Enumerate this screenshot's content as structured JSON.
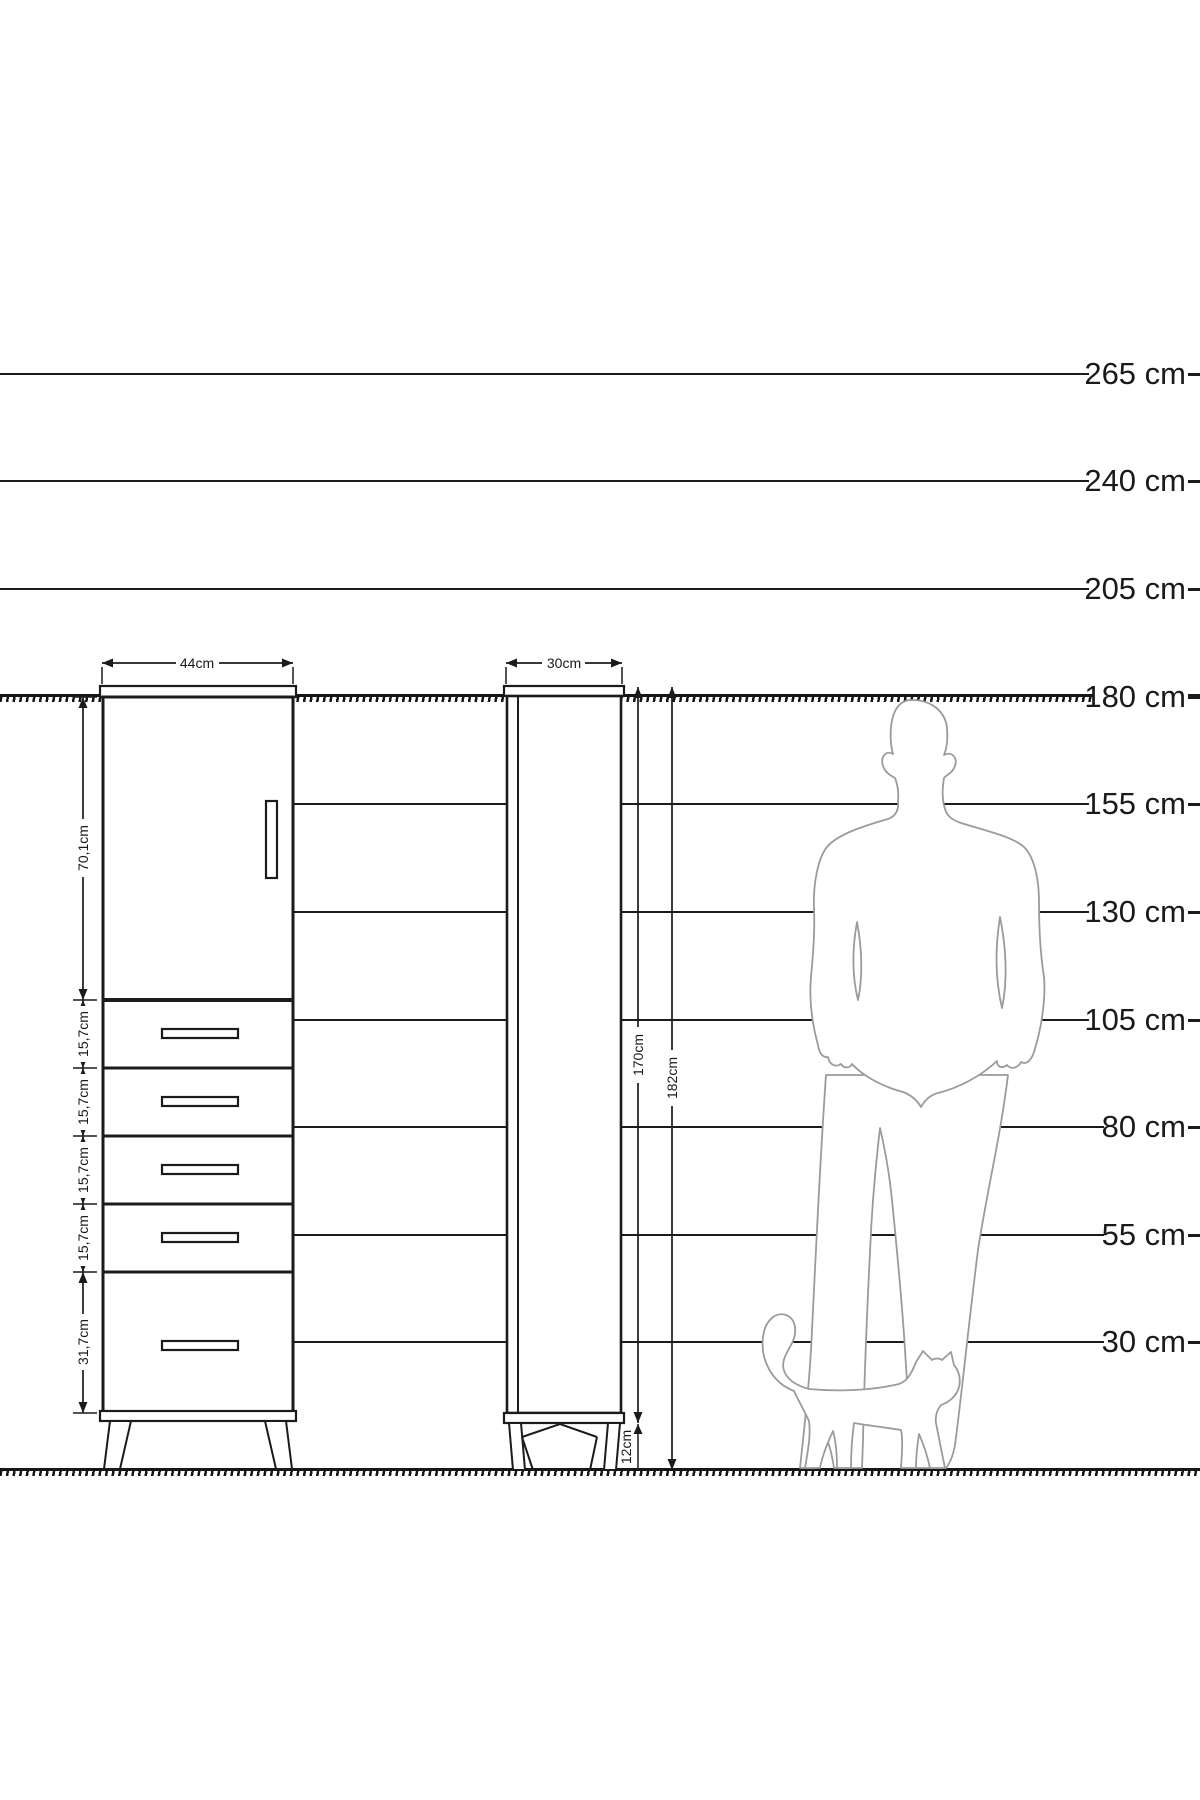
{
  "diagram": {
    "title": "Cabinet dimensions with human and cat height reference",
    "views": [
      "front view",
      "side view"
    ]
  },
  "scale": {
    "unit": "cm",
    "lines": [
      {
        "value": 265,
        "label": "265 cm"
      },
      {
        "value": 240,
        "label": "240 cm"
      },
      {
        "value": 205,
        "label": "205 cm"
      },
      {
        "value": 180,
        "label": "180 cm"
      },
      {
        "value": 155,
        "label": "155 cm"
      },
      {
        "value": 130,
        "label": "130 cm"
      },
      {
        "value": 105,
        "label": "105 cm"
      },
      {
        "value": 80,
        "label": "80 cm"
      },
      {
        "value": 55,
        "label": "55 cm"
      },
      {
        "value": 30,
        "label": "30 cm"
      }
    ]
  },
  "front_view": {
    "width_label": "44cm",
    "chain": [
      "70,1cm",
      "15,7cm",
      "15,7cm",
      "15,7cm",
      "15,7cm",
      "31,7cm"
    ],
    "drawer_count": 5
  },
  "side_view": {
    "width_label": "30cm",
    "body_height_label": "170cm",
    "total_height_label": "182cm",
    "leg_height_label": "12cm"
  },
  "figures": {
    "person": "standing man silhouette at 180 cm line",
    "cat": "walking cat silhouette"
  },
  "colors": {
    "ink": "#1b1b1b",
    "silhouette": "#9b9b9b",
    "background": "#ffffff"
  }
}
